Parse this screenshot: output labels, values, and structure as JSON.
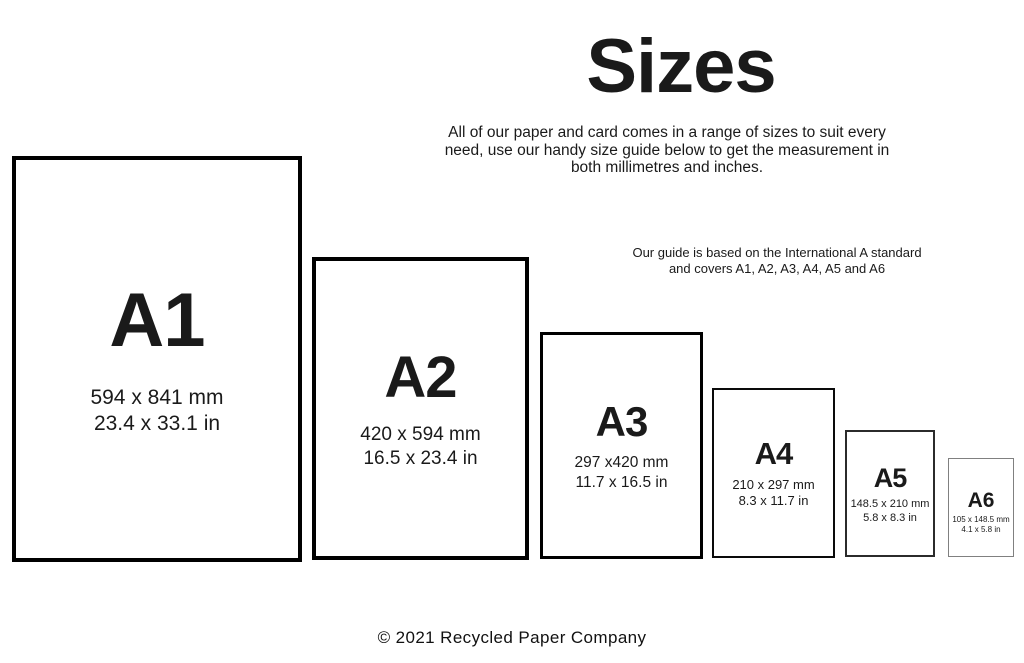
{
  "header": {
    "title": "Sizes",
    "subtitle_lines": [
      "All of our paper and card comes in a range of sizes to suit every",
      "need, use our handy size guide below to get the measurement in",
      "both millimetres and inches."
    ],
    "note_lines": [
      "Our guide is based on the International A standard",
      "and covers A1, A2, A3, A4, A5 and A6"
    ]
  },
  "sizes": [
    {
      "label": "A1",
      "mm": "594 x 841 mm",
      "inches": "23.4 x 33.1 in"
    },
    {
      "label": "A2",
      "mm": "420 x 594 mm",
      "inches": "16.5 x 23.4 in"
    },
    {
      "label": "A3",
      "mm": "297 x420 mm",
      "inches": "11.7 x 16.5 in"
    },
    {
      "label": "A4",
      "mm": "210 x 297 mm",
      "inches": "8.3 x 11.7 in"
    },
    {
      "label": "A5",
      "mm": "148.5 x 210 mm",
      "inches": "5.8 x 8.3 in"
    },
    {
      "label": "A6",
      "mm": "105 x 148.5 mm",
      "inches": "4.1 x 5.8 in"
    }
  ],
  "footer": {
    "copyright": "© 2021 Recycled Paper Company"
  },
  "colors": {
    "background": "#ffffff",
    "text": "#1a1a1a",
    "border": "#000000"
  }
}
